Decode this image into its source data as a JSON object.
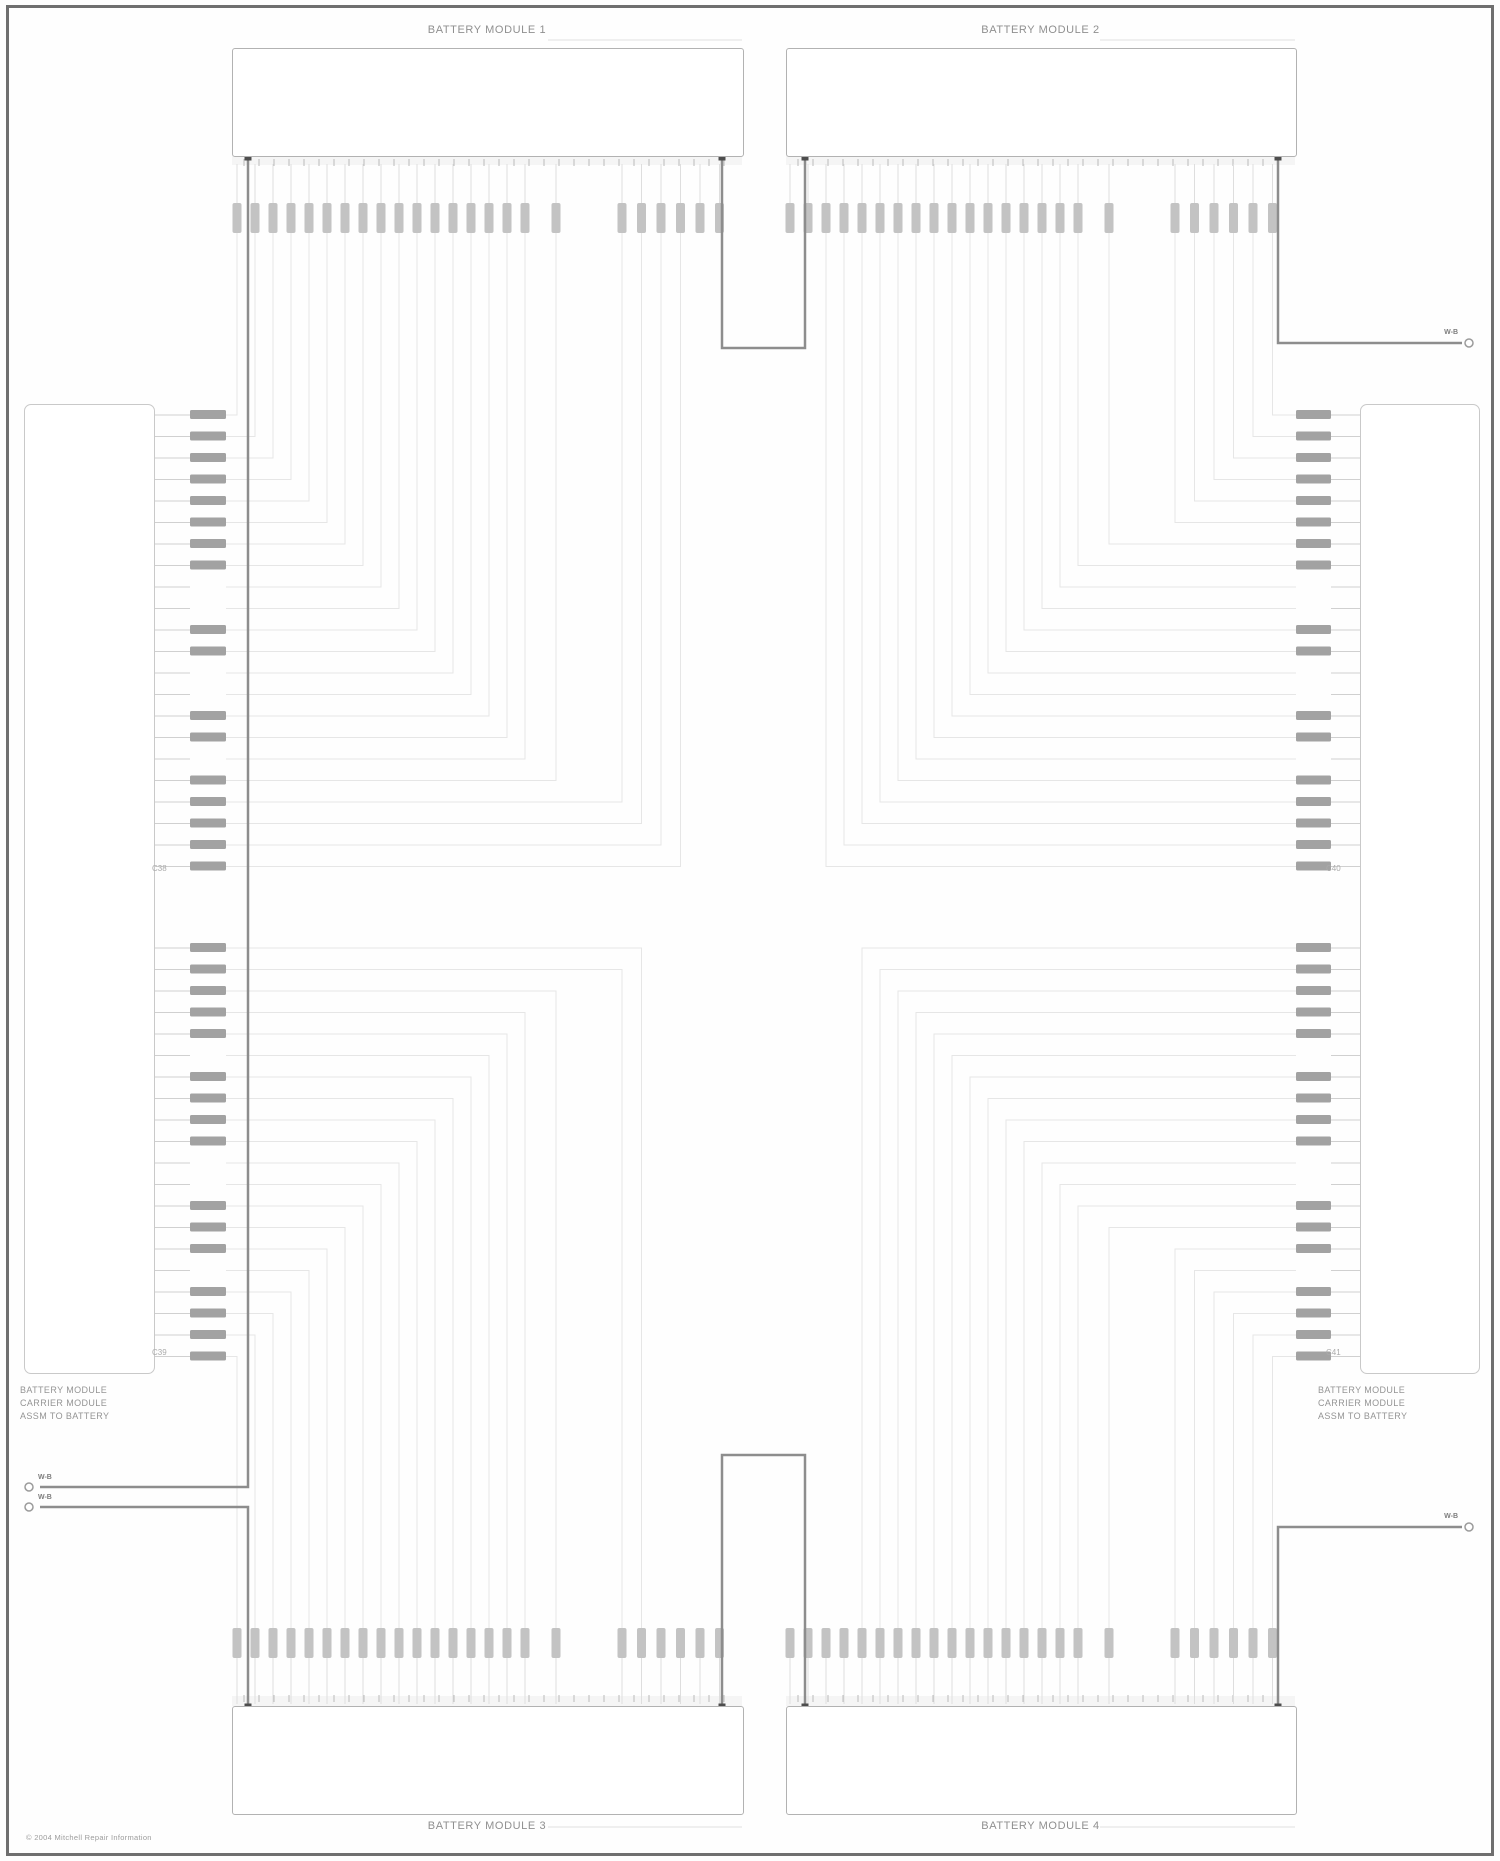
{
  "labels": {
    "module_top_left": "BATTERY MODULE 1",
    "module_top_right": "BATTERY MODULE 2",
    "module_bottom_left": "BATTERY MODULE 3",
    "module_bottom_right": "BATTERY MODULE 4",
    "left_connector": [
      "BATTERY MODULE",
      "CARRIER MODULE",
      "ASSM TO BATTERY"
    ],
    "right_connector": [
      "BATTERY MODULE",
      "CARRIER MODULE",
      "ASSM TO BATTERY"
    ],
    "stub_top_right": "W-B",
    "stub_bottom_right": "W-B",
    "bus_label_1": "W-B",
    "bus_label_2": "W-B",
    "connector_id_left_upper": "C38",
    "connector_id_left_lower": "C39",
    "connector_id_right_upper": "C40",
    "connector_id_right_lower": "C41",
    "footer": "© 2004 Mitchell Repair Information"
  },
  "colors": {
    "wire": "#e6e6e6",
    "stub": "#d0d0d0",
    "label_bar": "#8e8e8e",
    "terminal": "#c3c3c3",
    "power": "#8d8d8d",
    "dot": "#4d4d4d",
    "tick": "#b0b0b0",
    "pin_number": "#b9b9b9",
    "leader": "#e0e0e0",
    "ring": "#9b9b9b"
  },
  "geometry": {
    "modules": [
      {
        "name": "top-left",
        "x": 232,
        "y": 48,
        "w": 510,
        "h": 107,
        "side": "top",
        "dots": [
          [
            248,
            157
          ],
          [
            722,
            157
          ]
        ]
      },
      {
        "name": "top-right",
        "x": 786,
        "y": 48,
        "w": 509,
        "h": 107,
        "side": "top",
        "dots": [
          [
            805,
            157
          ],
          [
            1278,
            157
          ]
        ]
      },
      {
        "name": "bottom-left",
        "x": 232,
        "y": 1706,
        "w": 510,
        "h": 107,
        "side": "bottom",
        "dots": [
          [
            248,
            1707
          ],
          [
            722,
            1707
          ]
        ]
      },
      {
        "name": "bottom-right",
        "x": 786,
        "y": 1706,
        "w": 509,
        "h": 107,
        "side": "bottom",
        "dots": [
          [
            805,
            1707
          ],
          [
            1278,
            1707
          ]
        ]
      }
    ],
    "terminal_groups_left": [
      {
        "start": 237,
        "count": 17,
        "pitch": 18
      },
      {
        "start": 556,
        "count": 1,
        "pitch": 18
      },
      {
        "start": 622,
        "count": 6,
        "pitch": 19.5
      }
    ],
    "right_offset": 553,
    "terminal_rows": {
      "top_y": 203,
      "bottom_y": 1628,
      "w": 9,
      "h": 30
    },
    "rows": {
      "pitch": 21.5,
      "top": {
        "y0": 415,
        "count": 22
      },
      "bottom": {
        "y0": 948,
        "count": 20
      },
      "labels_top": [
        1,
        1,
        1,
        1,
        1,
        1,
        1,
        1,
        0,
        0,
        1,
        1,
        0,
        0,
        1,
        1,
        0,
        1,
        1,
        1,
        1,
        1
      ],
      "labels_bottom": [
        1,
        1,
        1,
        1,
        1,
        0,
        1,
        1,
        1,
        1,
        0,
        0,
        1,
        1,
        1,
        0,
        1,
        1,
        1,
        1
      ]
    },
    "left_box": {
      "x": 24,
      "y": 404,
      "w": 129,
      "h": 968
    },
    "right_box": {
      "x": 1360,
      "y": 404,
      "w": 118,
      "h": 968
    },
    "left_wire_x": {
      "box_edge": 153,
      "label_l": 190,
      "label_r": 226
    },
    "right_wire_x": {
      "box_edge": 1360,
      "label_l": 1296,
      "label_r": 1331
    },
    "power_links": [
      {
        "pts": [
          [
            722,
            157
          ],
          [
            722,
            348
          ],
          [
            805,
            348
          ],
          [
            805,
            157
          ]
        ]
      },
      {
        "pts": [
          [
            722,
            1707
          ],
          [
            722,
            1455
          ],
          [
            805,
            1455
          ],
          [
            805,
            1707
          ]
        ]
      },
      {
        "pts": [
          [
            1278,
            157
          ],
          [
            1278,
            343
          ],
          [
            1462,
            343
          ]
        ]
      },
      {
        "pts": [
          [
            1278,
            1707
          ],
          [
            1278,
            1527
          ],
          [
            1462,
            1527
          ]
        ]
      },
      {
        "pts": [
          [
            248,
            157
          ],
          [
            248,
            1487
          ],
          [
            40,
            1487
          ]
        ]
      },
      {
        "pts": [
          [
            40,
            1507
          ],
          [
            248,
            1507
          ],
          [
            248,
            1707
          ]
        ]
      }
    ],
    "rings": [
      [
        29,
        1487
      ],
      [
        29,
        1507
      ],
      [
        1469,
        343
      ],
      [
        1469,
        1527
      ]
    ],
    "leaders": [
      [
        [
          548,
          40
        ],
        [
          742,
          40
        ]
      ],
      [
        [
          1100,
          40
        ],
        [
          1295,
          40
        ]
      ],
      [
        [
          548,
          1827
        ],
        [
          742,
          1827
        ]
      ],
      [
        [
          1100,
          1827
        ],
        [
          1295,
          1827
        ]
      ]
    ]
  }
}
